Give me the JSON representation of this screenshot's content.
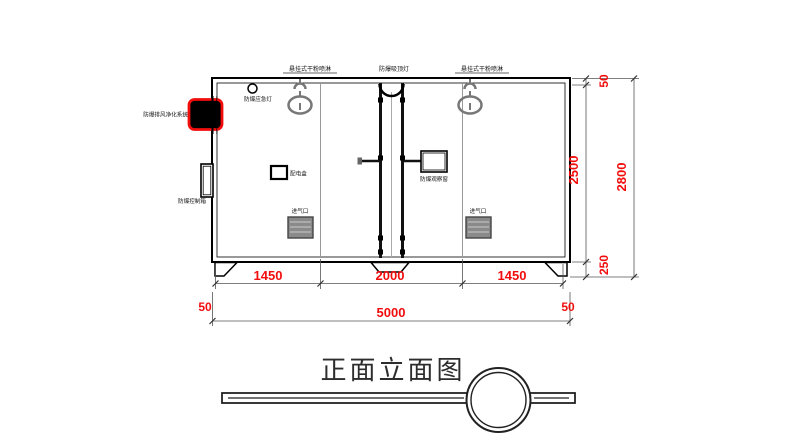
{
  "drawing_title": "正面立面图",
  "labels": {
    "sprinkler_left": "悬挂式干粉喷淋",
    "ceiling_lamp": "防爆吸顶灯",
    "sprinkler_right": "悬挂式干粉喷淋",
    "emergency_lamp": "防爆应急灯",
    "exhaust_system": "防爆排风净化系统",
    "control_box": "防爆控制箱",
    "distribution_box": "配电盒",
    "observation_window": "防爆观察窗",
    "air_inlet_left": "进气口",
    "air_inlet_right": "进气口"
  },
  "dimensions": {
    "bottom_segments": [
      "1450",
      "2000",
      "1450"
    ],
    "bottom_margin_left": "50",
    "bottom_total": "5000",
    "bottom_margin_right": "50",
    "right_top": "50",
    "right_body": "2500",
    "right_feet": "250",
    "right_total": "2800"
  },
  "colors": {
    "dimension_red": "#f20d0d",
    "highlight_red": "#f20d0d",
    "line_black": "#000000",
    "secondary_gray": "#808080"
  }
}
